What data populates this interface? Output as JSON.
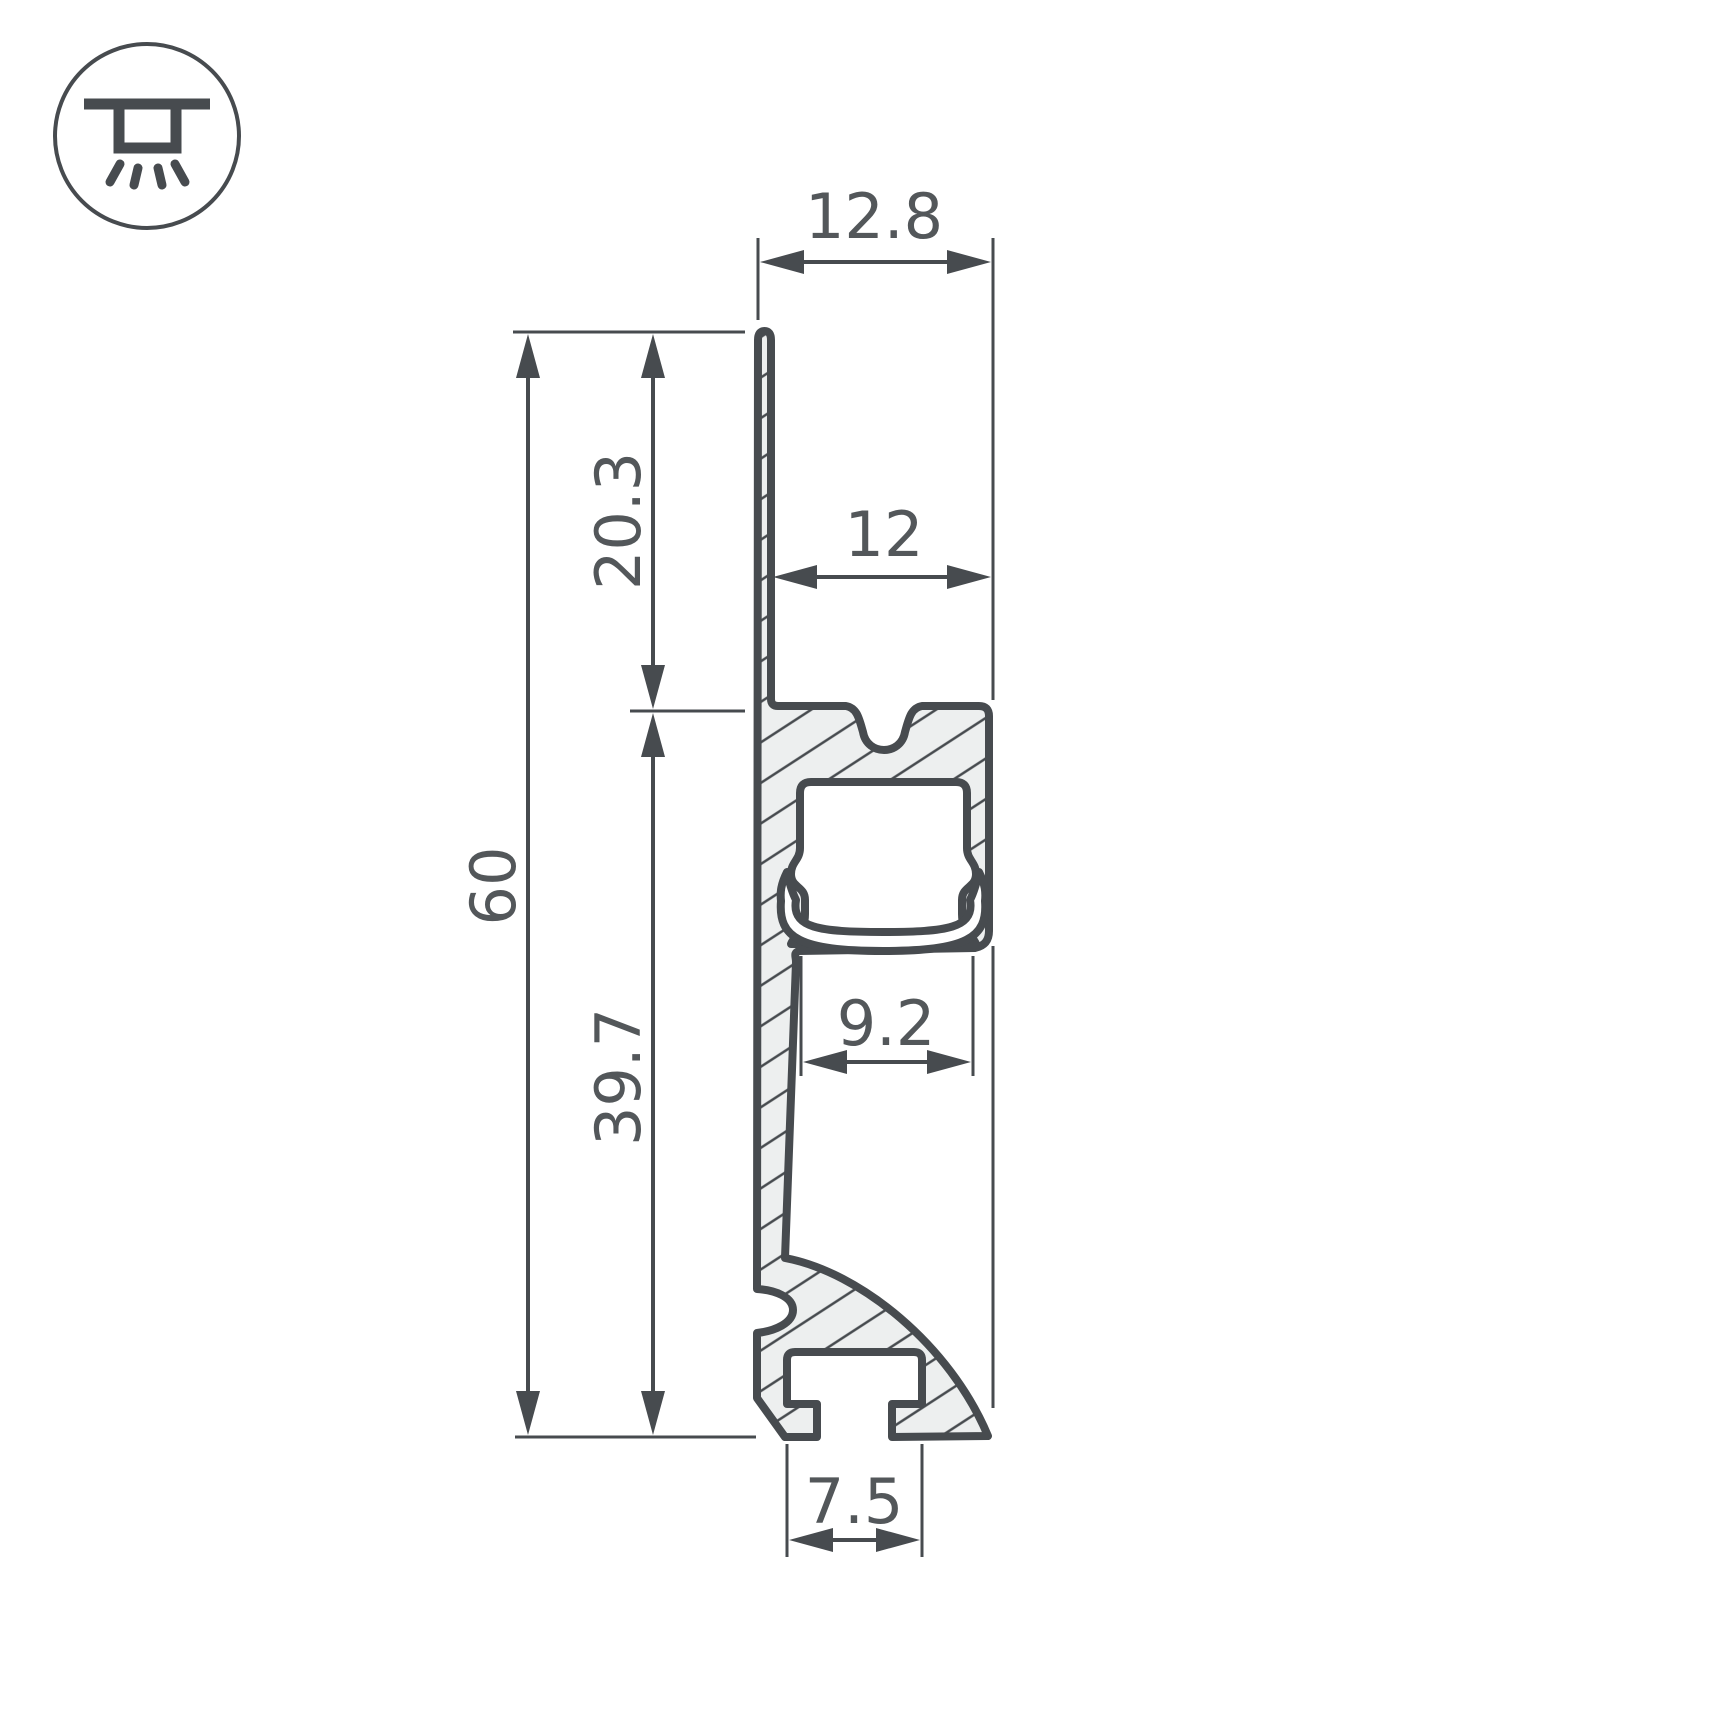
{
  "drawing": {
    "kind": "led-profile-cross-section",
    "icon": {
      "name": "recessed-mount-light-icon"
    },
    "colors": {
      "line": "#474b4f",
      "text": "#53575a",
      "hatch_fill": "#edefef",
      "background": "#ffffff"
    },
    "dimensions": {
      "top_width": {
        "value": "12.8",
        "orientation": "horizontal",
        "position": "top"
      },
      "flange_width": {
        "value": "12",
        "orientation": "horizontal",
        "position": "upper-middle"
      },
      "fin_height": {
        "value": "20.3",
        "orientation": "vertical",
        "position": "left-upper"
      },
      "total_height": {
        "value": "60",
        "orientation": "vertical",
        "position": "far-left"
      },
      "body_height": {
        "value": "39.7",
        "orientation": "vertical",
        "position": "left-lower"
      },
      "channel_width": {
        "value": "9.2",
        "orientation": "horizontal",
        "position": "middle"
      },
      "slot_width": {
        "value": "7.5",
        "orientation": "horizontal",
        "position": "bottom"
      }
    }
  }
}
